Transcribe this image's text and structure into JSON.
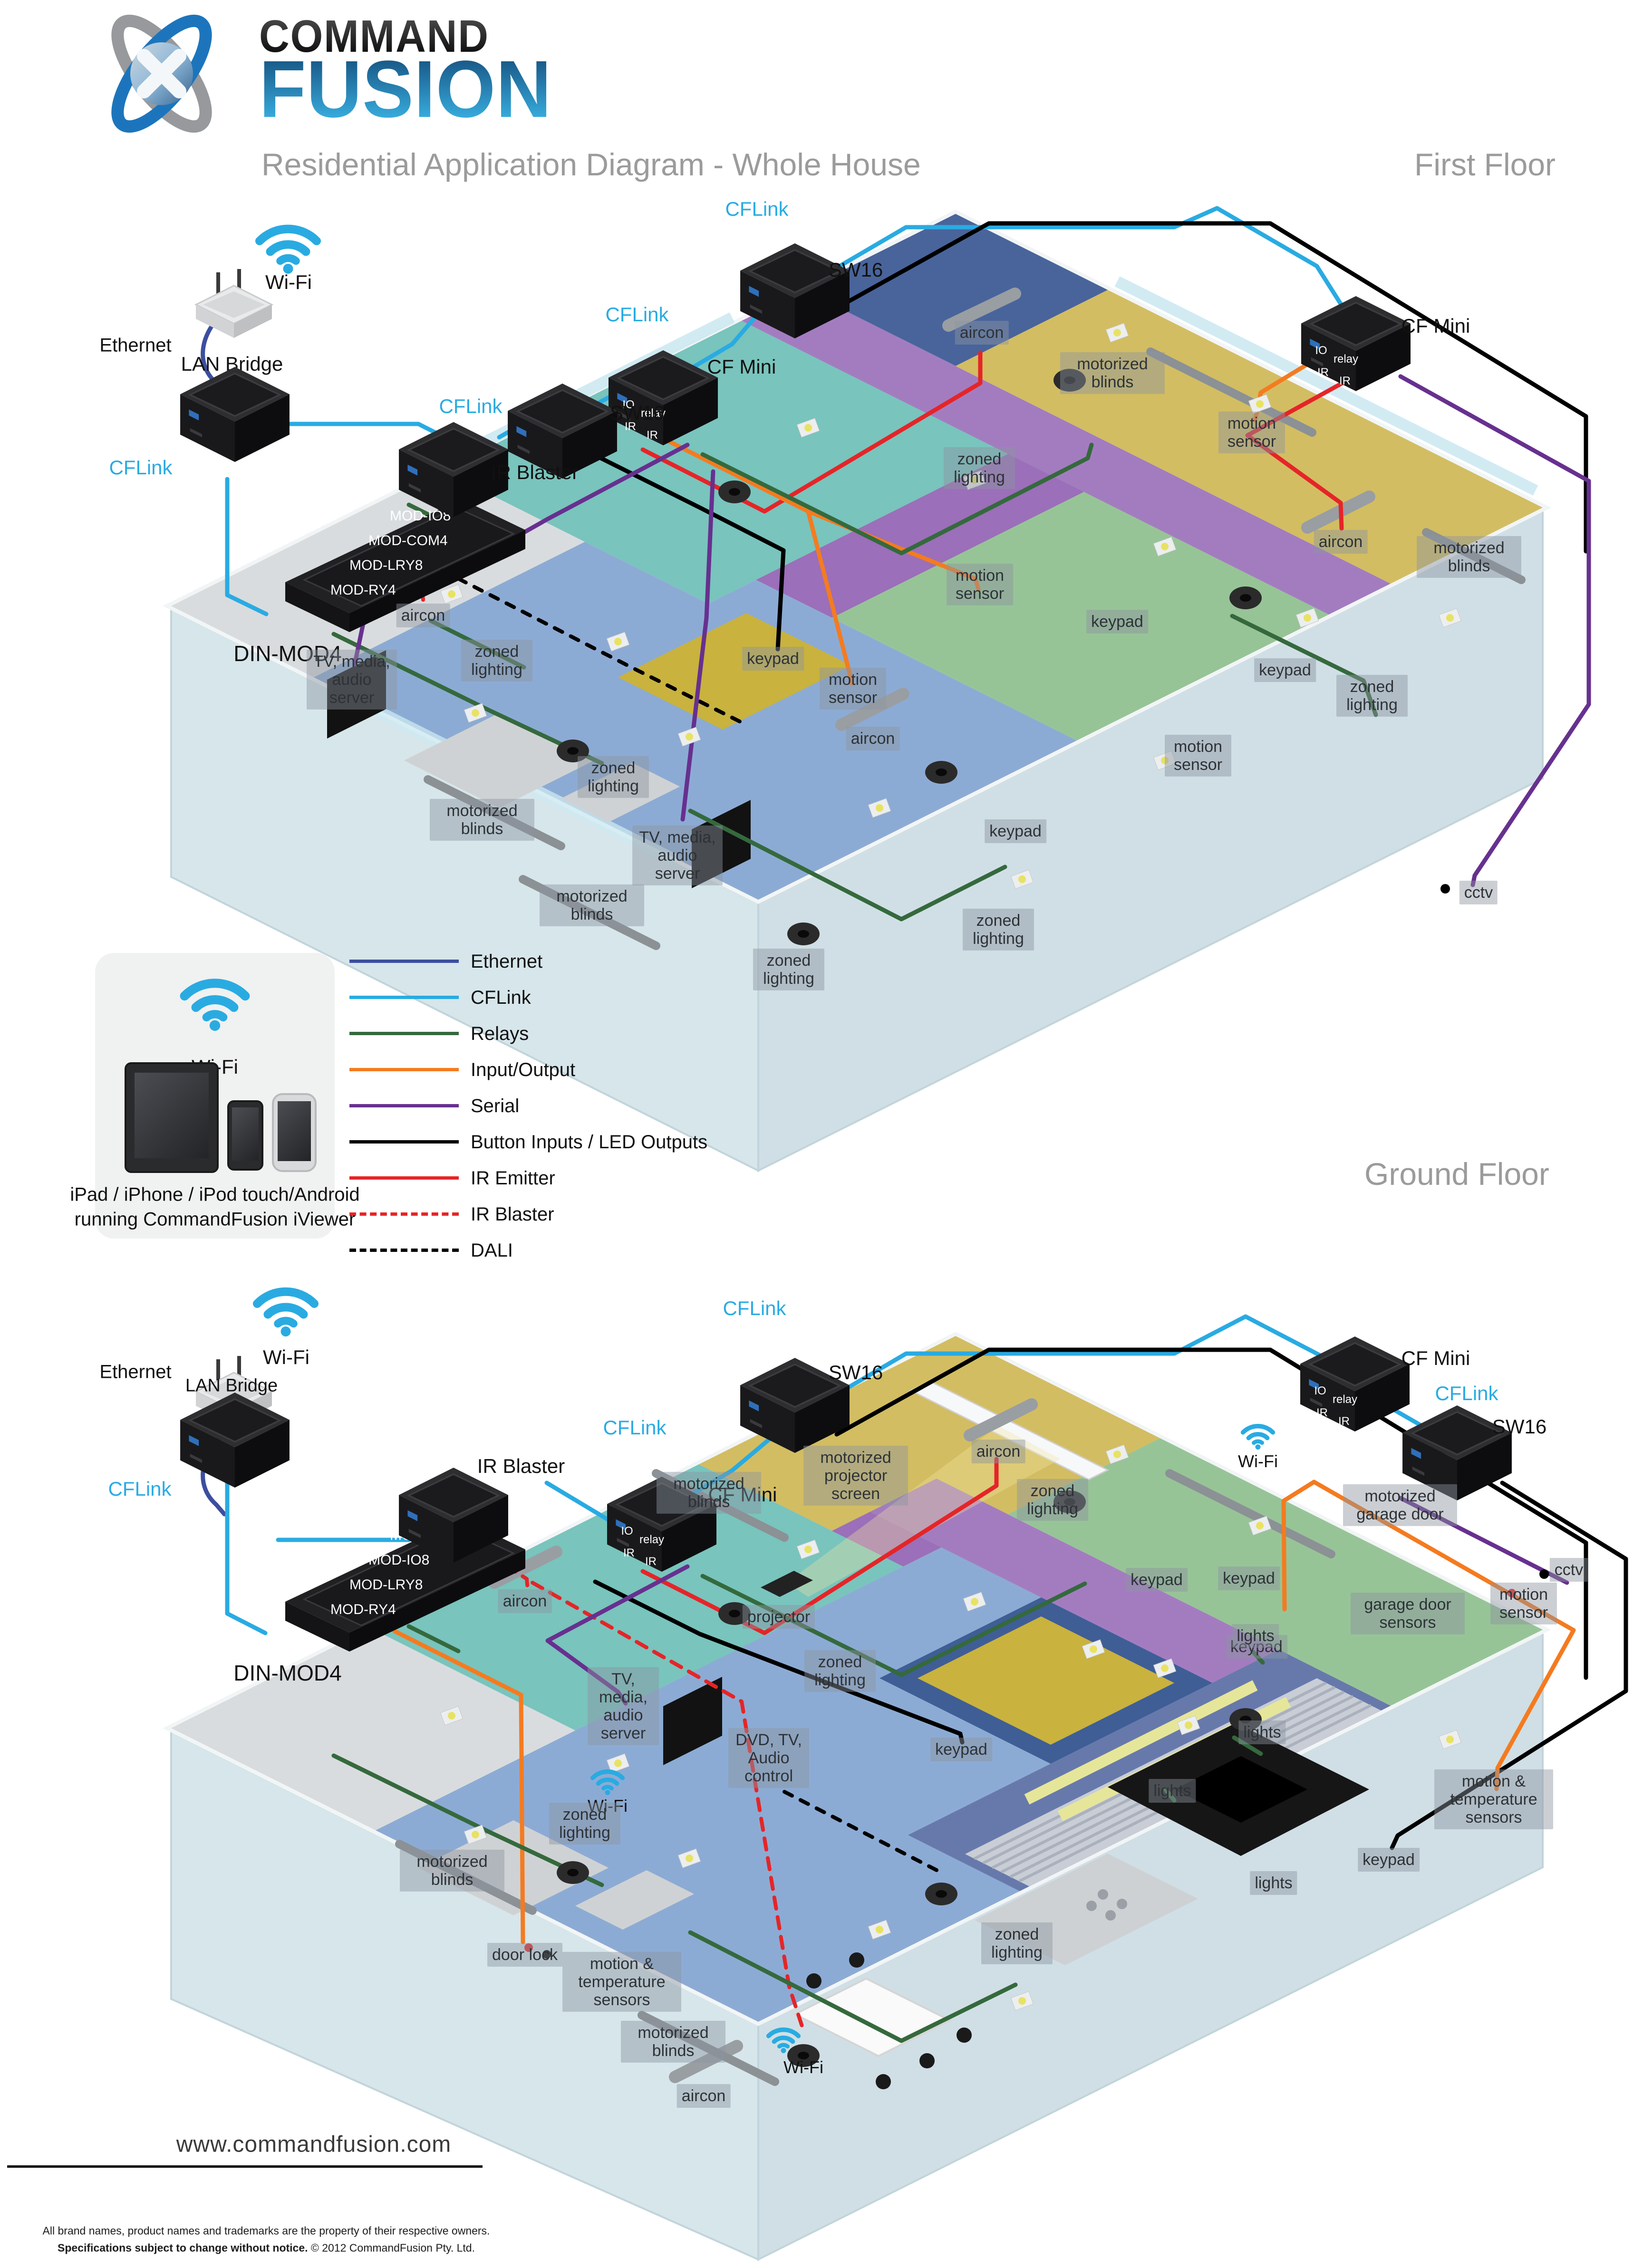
{
  "header": {
    "brand1": "COMMAND",
    "brand2": "FUSION",
    "subtitle": "Residential Application Diagram - Whole House",
    "floor1": "First Floor",
    "floor2": "Ground Floor"
  },
  "net": {
    "wifi": "Wi-Fi",
    "ethernet": "Ethernet",
    "lan": "LAN Bridge",
    "cflink": "CFLink",
    "din": "DIN-MOD4",
    "sw16": "SW16",
    "mini": "CF Mini",
    "irb": "IR Blaster",
    "io": "IO",
    "relay": "relay",
    "ir": "IR"
  },
  "ff_modules": [
    "MOD-IO8",
    "MOD-COM4",
    "MOD-LRY8",
    "MOD-RY4"
  ],
  "gf_modules": [
    "MOD-COM4",
    "MOD-IO8",
    "MOD-LRY8",
    "MOD-RY4"
  ],
  "labels": {
    "aircon": "aircon",
    "blinds": "motorized blinds",
    "zoned": "zoned lighting",
    "motion": "motion sensor",
    "keypad": "keypad",
    "tv": "TV, media, audio server",
    "cctv": "cctv",
    "screen": "motorized projector screen",
    "projector": "projector",
    "dvd": "DVD, TV, Audio control",
    "garage": "motorized garage door",
    "garage_sensors": "garage door sensors",
    "lights": "lights",
    "motion_temp": "motion & temperature sensors",
    "door_lock": "door lock"
  },
  "legend": {
    "entries": [
      {
        "label": "Ethernet",
        "color": "#3c4e9f",
        "dash": false
      },
      {
        "label": "CFLink",
        "color": "#29abe2",
        "dash": false
      },
      {
        "label": "Relays",
        "color": "#35693d",
        "dash": false
      },
      {
        "label": "Input/Output",
        "color": "#f47b20",
        "dash": false
      },
      {
        "label": "Serial",
        "color": "#67308f",
        "dash": false
      },
      {
        "label": "Button Inputs / LED Outputs",
        "color": "#000000",
        "dash": false
      },
      {
        "label": "IR Emitter",
        "color": "#e52528",
        "dash": false
      },
      {
        "label": "IR Blaster",
        "color": "#e52528",
        "dash": true
      },
      {
        "label": "DALI",
        "color": "#000000",
        "dash": true
      }
    ]
  },
  "viewer": {
    "wifi": "Wi-Fi",
    "line1": "iPad / iPhone / iPod touch/Android",
    "line2": "running CommandFusion iViewer"
  },
  "footer": {
    "url": "www.commandfusion.com",
    "fine1": "All brand names, product names and trademarks are the property of their respective owners.",
    "fine2_bold": "Specifications subject to change without notice.",
    "fine2_rest": " © 2012 CommandFusion Pty. Ltd."
  }
}
